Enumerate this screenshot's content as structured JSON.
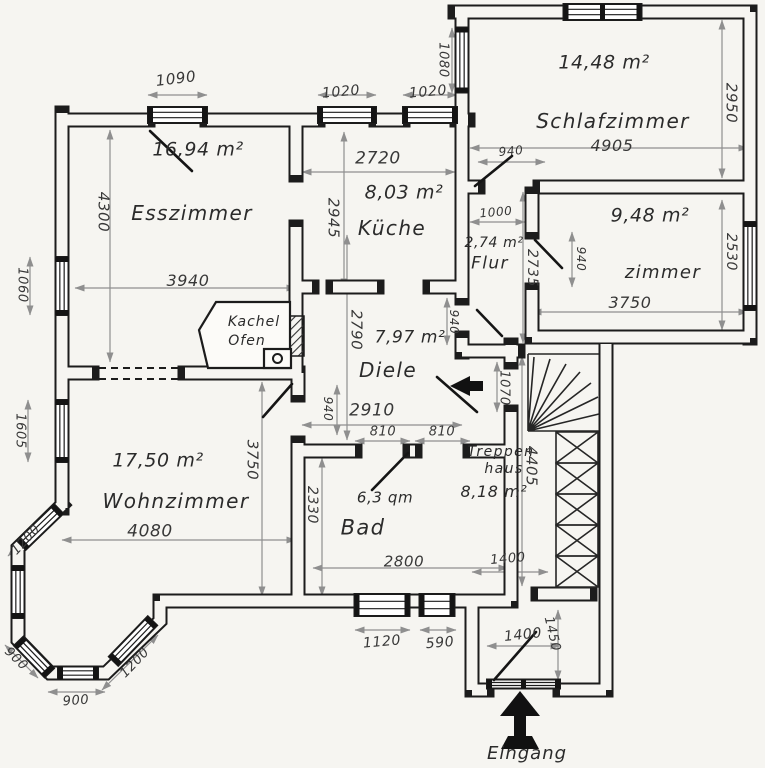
{
  "floorplan": {
    "colors": {
      "paper": "#f6f5f1",
      "wall": "#1c1c1c",
      "dim_line": "#8f8f8f",
      "ink": "#2b2b2b"
    },
    "rooms": [
      {
        "name": "Esszimmer",
        "area": "16,94 m²",
        "width": "3940",
        "height": "4300"
      },
      {
        "name": "Küche",
        "area": "8,03 m²",
        "width": "2720",
        "height": "2945"
      },
      {
        "name": "Schlafzimmer",
        "area": "14,48 m²",
        "width": "4905",
        "height": "2950"
      },
      {
        "name": "Flur",
        "area": "2,74 m²",
        "width": "1000",
        "height": "2735"
      },
      {
        "name": "zimmer",
        "area": "9,48 m²",
        "width": "3750",
        "height": "2530"
      },
      {
        "name": "Diele",
        "area": "7,97 m²",
        "width": "2910",
        "height": "2790"
      },
      {
        "name": "Wohnzimmer",
        "area": "17,50 m²",
        "width": "4080",
        "height": "3750"
      },
      {
        "name": "Bad",
        "area": "6,3 qm",
        "width": "2800",
        "height": "2330"
      },
      {
        "name": "Treppenhaus",
        "area": "8,18 m²",
        "height": "4405"
      }
    ],
    "features": {
      "stove": "Kachel Ofen",
      "entrance": "Eingang"
    },
    "annotations": [
      {
        "text": "16,94 m²",
        "x": 198,
        "y": 150,
        "size": 19,
        "kind": "room-area"
      },
      {
        "text": "Esszimmer",
        "x": 192,
        "y": 213,
        "size": 20,
        "kind": "room-name"
      },
      {
        "text": "3940",
        "x": 188,
        "y": 281,
        "size": 16,
        "kind": "dim"
      },
      {
        "text": "4300",
        "x": 103,
        "y": 212,
        "size": 15,
        "rot": 90,
        "kind": "dim"
      },
      {
        "text": "1090",
        "x": 176,
        "y": 79,
        "size": 15,
        "rot": -7,
        "kind": "dim"
      },
      {
        "text": "1020",
        "x": 341,
        "y": 92,
        "size": 14,
        "rot": -5,
        "kind": "dim"
      },
      {
        "text": "1020",
        "x": 428,
        "y": 92,
        "size": 14,
        "rot": -5,
        "kind": "dim"
      },
      {
        "text": "1080",
        "x": 443,
        "y": 60,
        "size": 13,
        "rot": 90,
        "kind": "dim"
      },
      {
        "text": "14,48 m²",
        "x": 604,
        "y": 63,
        "size": 19,
        "kind": "room-area"
      },
      {
        "text": "Schlafzimmer",
        "x": 613,
        "y": 121,
        "size": 20,
        "kind": "room-name"
      },
      {
        "text": "4905",
        "x": 612,
        "y": 146,
        "size": 16,
        "kind": "dim"
      },
      {
        "text": "2950",
        "x": 731,
        "y": 103,
        "size": 15,
        "rot": 90,
        "kind": "dim"
      },
      {
        "text": "940",
        "x": 511,
        "y": 151,
        "size": 12,
        "rot": -5,
        "kind": "dim"
      },
      {
        "text": "2720",
        "x": 378,
        "y": 159,
        "size": 17,
        "kind": "dim"
      },
      {
        "text": "2945",
        "x": 333,
        "y": 218,
        "size": 15,
        "rot": 90,
        "kind": "dim"
      },
      {
        "text": "8,03 m²",
        "x": 404,
        "y": 193,
        "size": 19,
        "kind": "room-area"
      },
      {
        "text": "Küche",
        "x": 392,
        "y": 228,
        "size": 20,
        "kind": "room-name"
      },
      {
        "text": "1000",
        "x": 496,
        "y": 212,
        "size": 12,
        "rot": -5,
        "kind": "dim"
      },
      {
        "text": "2,74 m²",
        "x": 494,
        "y": 243,
        "size": 14,
        "kind": "room-area"
      },
      {
        "text": "Flur",
        "x": 490,
        "y": 264,
        "size": 17,
        "kind": "room-name"
      },
      {
        "text": "2735",
        "x": 532,
        "y": 268,
        "size": 14,
        "rot": 90,
        "kind": "dim"
      },
      {
        "text": "940",
        "x": 581,
        "y": 259,
        "size": 12,
        "rot": 90,
        "kind": "dim"
      },
      {
        "text": "9,48 m²",
        "x": 650,
        "y": 216,
        "size": 19,
        "kind": "room-area"
      },
      {
        "text": "zimmer",
        "x": 663,
        "y": 273,
        "size": 18,
        "kind": "room-name"
      },
      {
        "text": "3750",
        "x": 630,
        "y": 303,
        "size": 16,
        "kind": "dim"
      },
      {
        "text": "2530",
        "x": 731,
        "y": 252,
        "size": 14,
        "rot": 90,
        "kind": "dim"
      },
      {
        "text": "1060",
        "x": 22,
        "y": 285,
        "size": 13,
        "rot": 90,
        "kind": "dim"
      },
      {
        "text": "1605",
        "x": 20,
        "y": 431,
        "size": 13,
        "rot": 90,
        "kind": "dim"
      },
      {
        "text": "Kachel",
        "x": 254,
        "y": 322,
        "size": 14,
        "kind": "feature"
      },
      {
        "text": "Ofen",
        "x": 247,
        "y": 341,
        "size": 14,
        "kind": "feature"
      },
      {
        "text": "2790",
        "x": 356,
        "y": 330,
        "size": 15,
        "rot": 90,
        "kind": "dim"
      },
      {
        "text": "7,97 m²",
        "x": 410,
        "y": 338,
        "size": 17,
        "kind": "room-area"
      },
      {
        "text": "Diele",
        "x": 388,
        "y": 370,
        "size": 20,
        "kind": "room-name"
      },
      {
        "text": "940",
        "x": 454,
        "y": 322,
        "size": 12,
        "rot": 90,
        "kind": "dim"
      },
      {
        "text": "1070",
        "x": 504,
        "y": 388,
        "size": 13,
        "rot": 90,
        "kind": "dim"
      },
      {
        "text": "940",
        "x": 328,
        "y": 409,
        "size": 12,
        "rot": 90,
        "kind": "dim"
      },
      {
        "text": "2910",
        "x": 372,
        "y": 411,
        "size": 17,
        "kind": "dim"
      },
      {
        "text": "810",
        "x": 383,
        "y": 432,
        "size": 13,
        "kind": "dim"
      },
      {
        "text": "810",
        "x": 442,
        "y": 432,
        "size": 13,
        "kind": "dim"
      },
      {
        "text": "Treppen",
        "x": 501,
        "y": 452,
        "size": 14,
        "kind": "room-name"
      },
      {
        "text": "haus",
        "x": 504,
        "y": 469,
        "size": 14,
        "kind": "room-name"
      },
      {
        "text": "8,18 m²",
        "x": 494,
        "y": 492,
        "size": 16,
        "kind": "room-area"
      },
      {
        "text": "4405",
        "x": 531,
        "y": 466,
        "size": 15,
        "rot": 90,
        "kind": "dim"
      },
      {
        "text": "17,50 m²",
        "x": 158,
        "y": 461,
        "size": 19,
        "kind": "room-area"
      },
      {
        "text": "Wohnzimmer",
        "x": 176,
        "y": 501,
        "size": 20,
        "kind": "room-name"
      },
      {
        "text": "4080",
        "x": 150,
        "y": 532,
        "size": 17,
        "kind": "dim"
      },
      {
        "text": "3750",
        "x": 252,
        "y": 460,
        "size": 15,
        "rot": 90,
        "kind": "dim"
      },
      {
        "text": "2330",
        "x": 312,
        "y": 505,
        "size": 14,
        "rot": 90,
        "kind": "dim"
      },
      {
        "text": "6,3 qm",
        "x": 385,
        "y": 498,
        "size": 15,
        "kind": "room-area"
      },
      {
        "text": "Bad",
        "x": 363,
        "y": 528,
        "size": 21,
        "kind": "room-name"
      },
      {
        "text": "2800",
        "x": 404,
        "y": 562,
        "size": 15,
        "kind": "dim"
      },
      {
        "text": "1400",
        "x": 508,
        "y": 559,
        "size": 13,
        "rot": -5,
        "kind": "dim"
      },
      {
        "text": "1120",
        "x": 382,
        "y": 642,
        "size": 14,
        "rot": -5,
        "kind": "dim"
      },
      {
        "text": "590",
        "x": 440,
        "y": 643,
        "size": 14,
        "rot": -5,
        "kind": "dim"
      },
      {
        "text": "1400",
        "x": 523,
        "y": 635,
        "size": 14,
        "rot": -6,
        "kind": "dim"
      },
      {
        "text": "1450",
        "x": 552,
        "y": 634,
        "size": 13,
        "rot": 77,
        "kind": "dim"
      },
      {
        "text": "1200",
        "x": 26,
        "y": 540,
        "size": 13,
        "rot": -47,
        "kind": "dim"
      },
      {
        "text": "900",
        "x": 16,
        "y": 659,
        "size": 13,
        "rot": 44,
        "kind": "dim"
      },
      {
        "text": "900",
        "x": 76,
        "y": 701,
        "size": 13,
        "rot": -4,
        "kind": "dim"
      },
      {
        "text": "1200",
        "x": 135,
        "y": 663,
        "size": 13,
        "rot": -46,
        "kind": "dim"
      },
      {
        "text": "Eingang",
        "x": 527,
        "y": 754,
        "size": 18,
        "kind": "feature"
      }
    ]
  }
}
